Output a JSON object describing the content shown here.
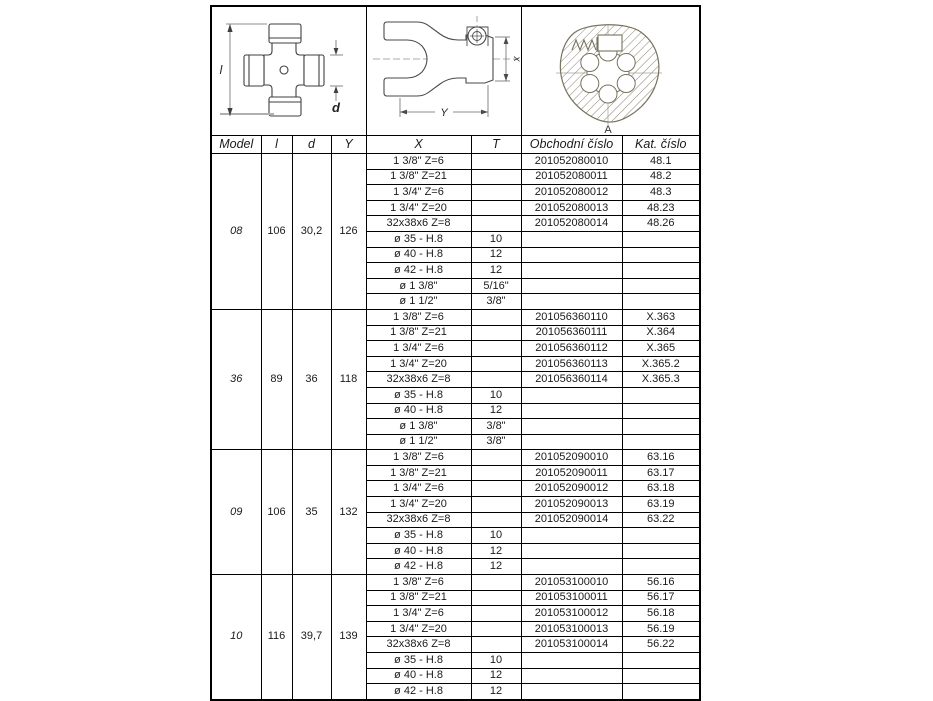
{
  "diagrams": {
    "cross_journal": {
      "dim_left": "l",
      "dim_right": "d"
    },
    "yoke": {
      "dim_x": "x",
      "dim_y": "Y"
    },
    "spline_bore": {
      "label": "A"
    }
  },
  "table": {
    "headers": {
      "model": "Model",
      "l": "l",
      "d": "d",
      "y": "Y",
      "x": "X",
      "t": "T",
      "obchodni": "Obchodní číslo",
      "kat": "Kat. číslo"
    },
    "blocks": [
      {
        "model": "08",
        "l": "106",
        "d": "30,2",
        "y": "126",
        "rows": [
          {
            "x": "1 3/8\" Z=6",
            "t": "",
            "obchodni": "201052080010",
            "kat": "48.1"
          },
          {
            "x": "1 3/8\" Z=21",
            "t": "",
            "obchodni": "201052080011",
            "kat": "48.2"
          },
          {
            "x": "1 3/4\" Z=6",
            "t": "",
            "obchodni": "201052080012",
            "kat": "48.3"
          },
          {
            "x": "1 3/4\" Z=20",
            "t": "",
            "obchodni": "201052080013",
            "kat": "48.23"
          },
          {
            "x": "32x38x6 Z=8",
            "t": "",
            "obchodni": "201052080014",
            "kat": "48.26"
          },
          {
            "x": "ø 35 - H.8",
            "t": "10",
            "obchodni": "",
            "kat": ""
          },
          {
            "x": "ø 40 - H.8",
            "t": "12",
            "obchodni": "",
            "kat": ""
          },
          {
            "x": "ø 42 - H.8",
            "t": "12",
            "obchodni": "",
            "kat": ""
          },
          {
            "x": "ø 1 3/8\"",
            "t": "5/16\"",
            "obchodni": "",
            "kat": ""
          },
          {
            "x": "ø 1 1/2\"",
            "t": "3/8\"",
            "obchodni": "",
            "kat": ""
          }
        ]
      },
      {
        "model": "36",
        "l": "89",
        "d": "36",
        "y": "118",
        "rows": [
          {
            "x": "1 3/8\" Z=6",
            "t": "",
            "obchodni": "201056360110",
            "kat": "X.363"
          },
          {
            "x": "1 3/8\" Z=21",
            "t": "",
            "obchodni": "201056360111",
            "kat": "X.364"
          },
          {
            "x": "1 3/4\" Z=6",
            "t": "",
            "obchodni": "201056360112",
            "kat": "X.365"
          },
          {
            "x": "1 3/4\" Z=20",
            "t": "",
            "obchodni": "201056360113",
            "kat": "X.365.2"
          },
          {
            "x": "32x38x6 Z=8",
            "t": "",
            "obchodni": "201056360114",
            "kat": "X.365.3"
          },
          {
            "x": "ø 35 - H.8",
            "t": "10",
            "obchodni": "",
            "kat": ""
          },
          {
            "x": "ø 40 - H.8",
            "t": "12",
            "obchodni": "",
            "kat": ""
          },
          {
            "x": "ø 1 3/8\"",
            "t": "3/8\"",
            "obchodni": "",
            "kat": ""
          },
          {
            "x": "ø 1 1/2\"",
            "t": "3/8\"",
            "obchodni": "",
            "kat": ""
          }
        ]
      },
      {
        "model": "09",
        "l": "106",
        "d": "35",
        "y": "132",
        "rows": [
          {
            "x": "1 3/8\" Z=6",
            "t": "",
            "obchodni": "201052090010",
            "kat": "63.16"
          },
          {
            "x": "1 3/8\" Z=21",
            "t": "",
            "obchodni": "201052090011",
            "kat": "63.17"
          },
          {
            "x": "1 3/4\" Z=6",
            "t": "",
            "obchodni": "201052090012",
            "kat": "63.18"
          },
          {
            "x": "1 3/4\" Z=20",
            "t": "",
            "obchodni": "201052090013",
            "kat": "63.19"
          },
          {
            "x": "32x38x6 Z=8",
            "t": "",
            "obchodni": "201052090014",
            "kat": "63.22"
          },
          {
            "x": "ø 35 - H.8",
            "t": "10",
            "obchodni": "",
            "kat": ""
          },
          {
            "x": "ø 40 - H.8",
            "t": "12",
            "obchodni": "",
            "kat": ""
          },
          {
            "x": "ø 42 - H.8",
            "t": "12",
            "obchodni": "",
            "kat": ""
          }
        ]
      },
      {
        "model": "10",
        "l": "116",
        "d": "39,7",
        "y": "139",
        "rows": [
          {
            "x": "1 3/8\" Z=6",
            "t": "",
            "obchodni": "201053100010",
            "kat": "56.16"
          },
          {
            "x": "1 3/8\" Z=21",
            "t": "",
            "obchodni": "201053100011",
            "kat": "56.17"
          },
          {
            "x": "1 3/4\" Z=6",
            "t": "",
            "obchodni": "201053100012",
            "kat": "56.18"
          },
          {
            "x": "1 3/4\" Z=20",
            "t": "",
            "obchodni": "201053100013",
            "kat": "56.19"
          },
          {
            "x": "32x38x6 Z=8",
            "t": "",
            "obchodni": "201053100014",
            "kat": "56.22"
          },
          {
            "x": "ø 35 - H.8",
            "t": "10",
            "obchodni": "",
            "kat": ""
          },
          {
            "x": "ø 40 - H.8",
            "t": "12",
            "obchodni": "",
            "kat": ""
          },
          {
            "x": "ø 42 - H.8",
            "t": "12",
            "obchodni": "",
            "kat": ""
          }
        ]
      }
    ]
  }
}
